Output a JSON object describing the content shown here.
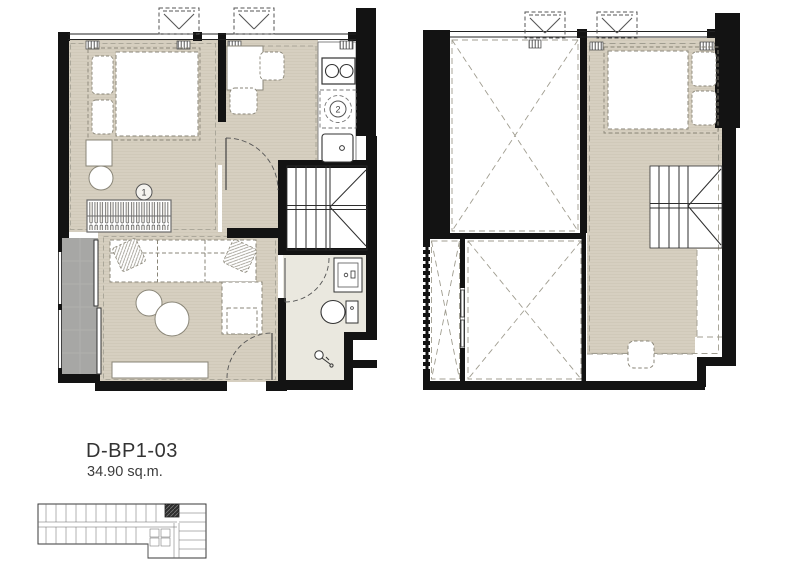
{
  "unit": {
    "code": "D-BP1-03",
    "area": "34.90 sq.m."
  },
  "markers": {
    "m1": "1",
    "m2": "2"
  },
  "colors": {
    "wall": "#131313",
    "wood_floor": "#d6cfc0",
    "tile_floor": "#eae8df",
    "balcony_floor": "#a7a7a5",
    "furniture_dash": "#8a8678",
    "void_dash": "#a09d90",
    "background": "#ffffff"
  }
}
